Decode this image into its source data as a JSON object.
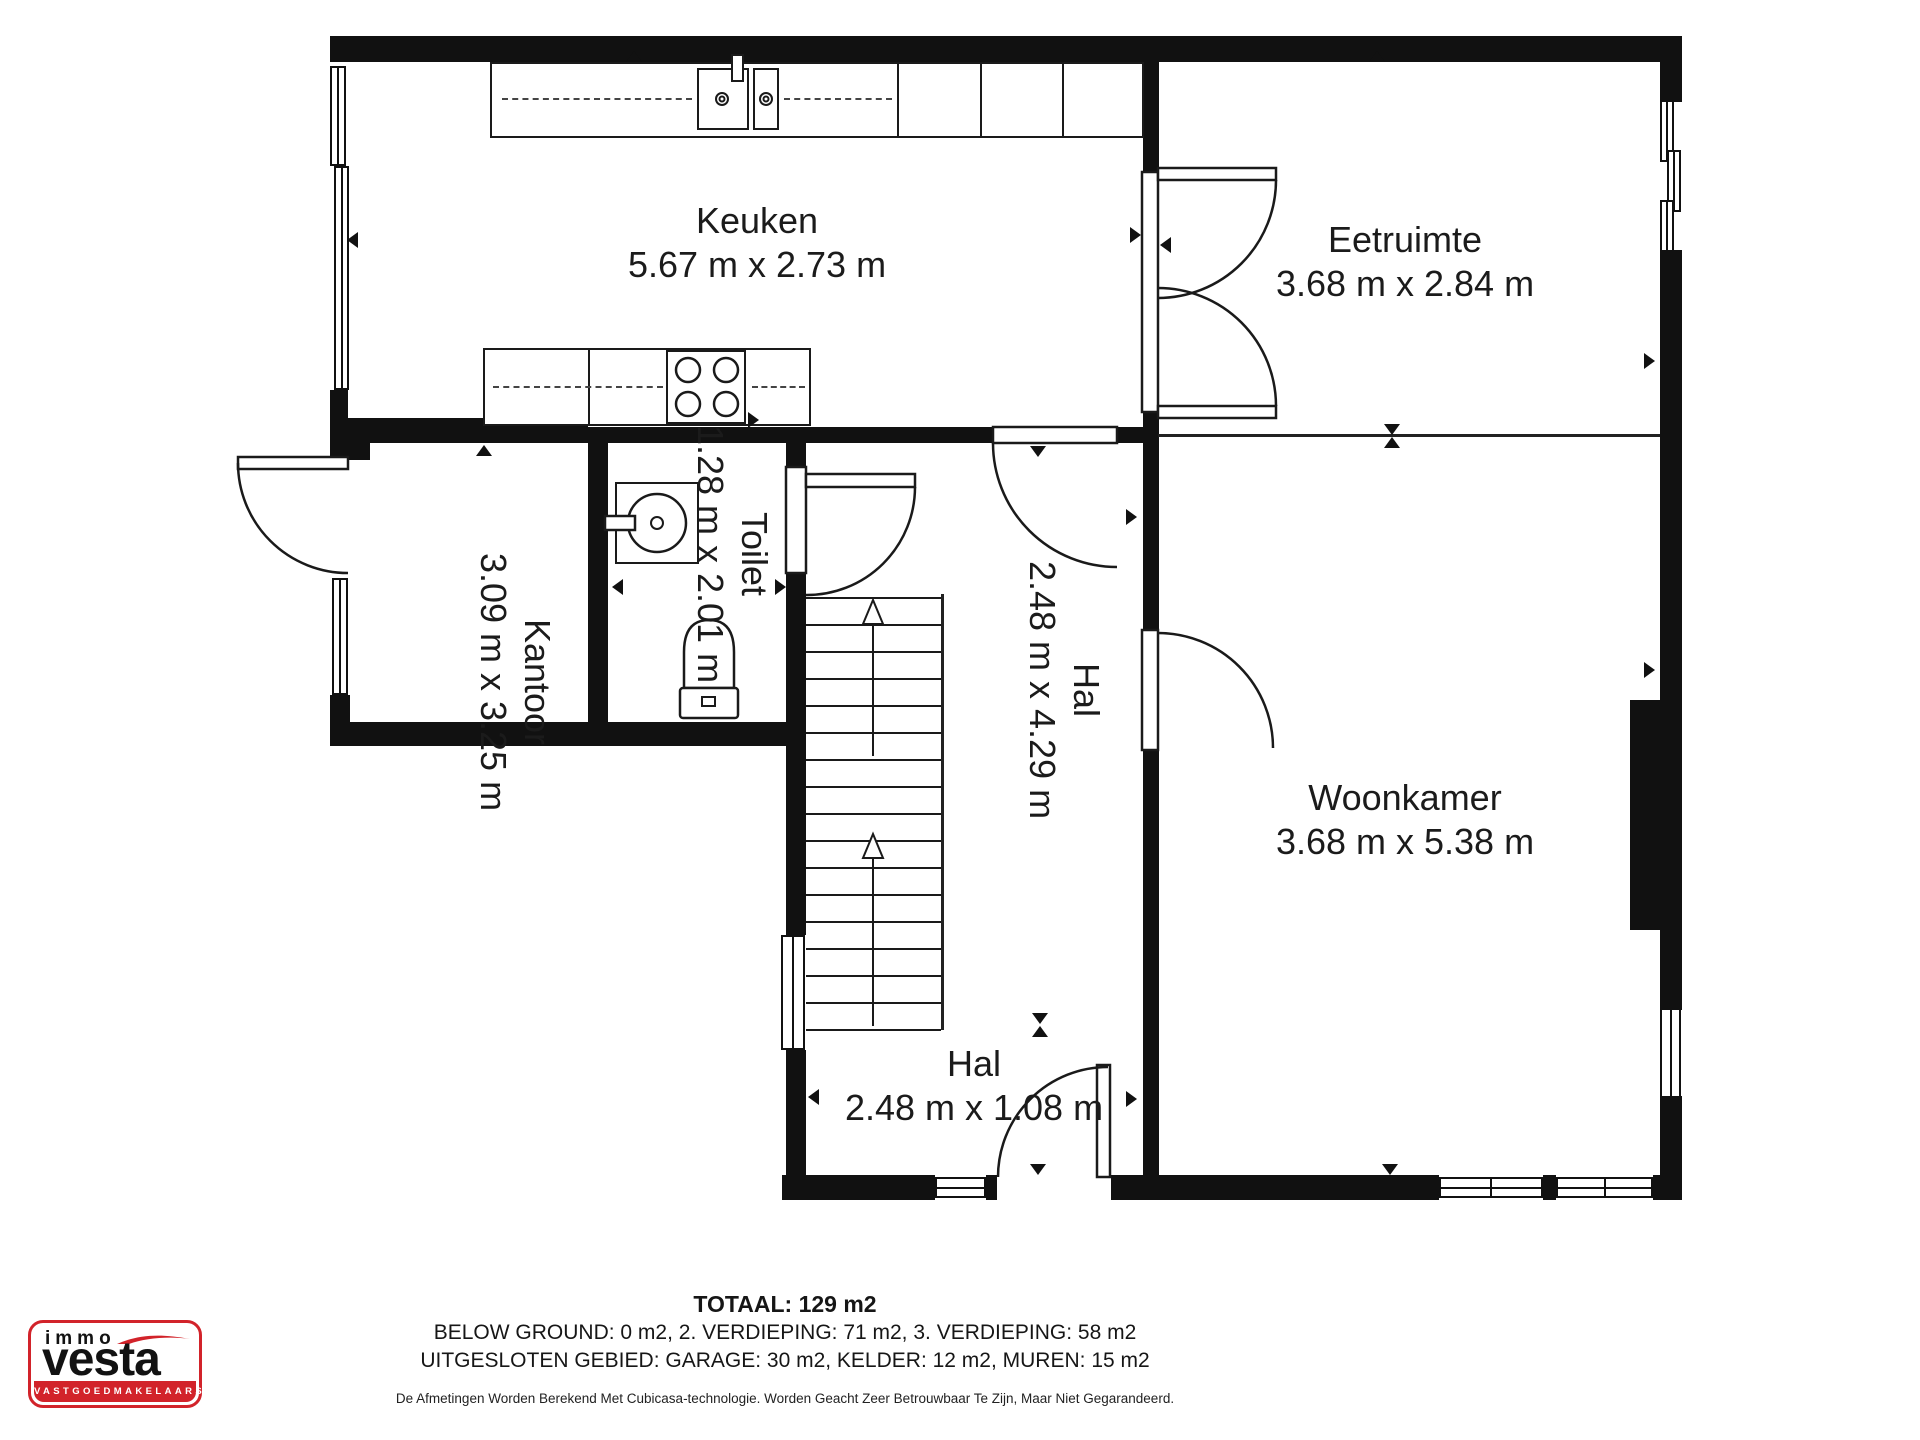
{
  "rooms": {
    "keuken": {
      "name": "Keuken",
      "dims": "5.67 m x 2.73 m"
    },
    "eetruimte": {
      "name": "Eetruimte",
      "dims": "3.68 m x 2.84 m"
    },
    "kantoor": {
      "name": "Kantoor",
      "dims": "3.09 m x 3.25 m"
    },
    "toilet": {
      "name": "Toilet",
      "dims": "1.28 m x 2.01 m"
    },
    "hal_boven": {
      "name": "Hal",
      "dims": "2.48 m x 4.29 m"
    },
    "woonkamer": {
      "name": "Woonkamer",
      "dims": "3.68 m x 5.38 m"
    },
    "hal_beneden": {
      "name": "Hal",
      "dims": "2.48 m x 1.08 m"
    }
  },
  "summary": {
    "total": "TOTAAL: 129 m2",
    "line2": "BELOW GROUND: 0 m2, 2. VERDIEPING: 71 m2, 3. VERDIEPING: 58 m2",
    "line3": "UITGESLOTEN GEBIED: GARAGE: 30 m2, KELDER: 12 m2, MUREN: 15 m2",
    "disclaimer": "De Afmetingen Worden Berekend Met Cubicasa-technologie. Worden Geacht Zeer Betrouwbaar Te Zijn, Maar Niet Gegarandeerd."
  },
  "logo": {
    "line1": "immo",
    "line2": "vesta",
    "line3": "VASTGOEDMAKELAARS"
  },
  "colors": {
    "wall": "#111111",
    "accent_red": "#d2232a"
  }
}
